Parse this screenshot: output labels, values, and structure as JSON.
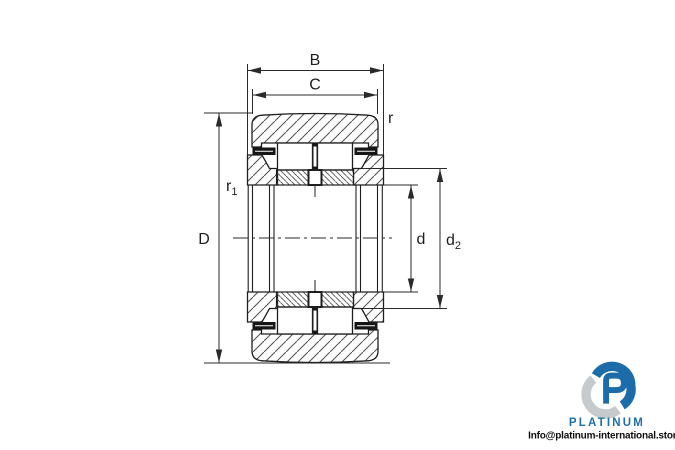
{
  "drawing": {
    "type": "bearing cross-section technical drawing",
    "dimension_labels": {
      "B": "B",
      "C": "C",
      "r": "r",
      "r1": {
        "base": "r",
        "sub": "1"
      },
      "D": "D",
      "d": "d",
      "d2": {
        "base": "d",
        "sub": "2"
      }
    },
    "line_color": "#2a2a2a",
    "hatch_color": "#4f4f4f"
  },
  "branding": {
    "name": "PLATINUM",
    "email": "Info@platinum-international.store",
    "logo_blue": "#1b6ca8",
    "logo_gray": "#c6cacd",
    "name_color": "#2171a5"
  }
}
